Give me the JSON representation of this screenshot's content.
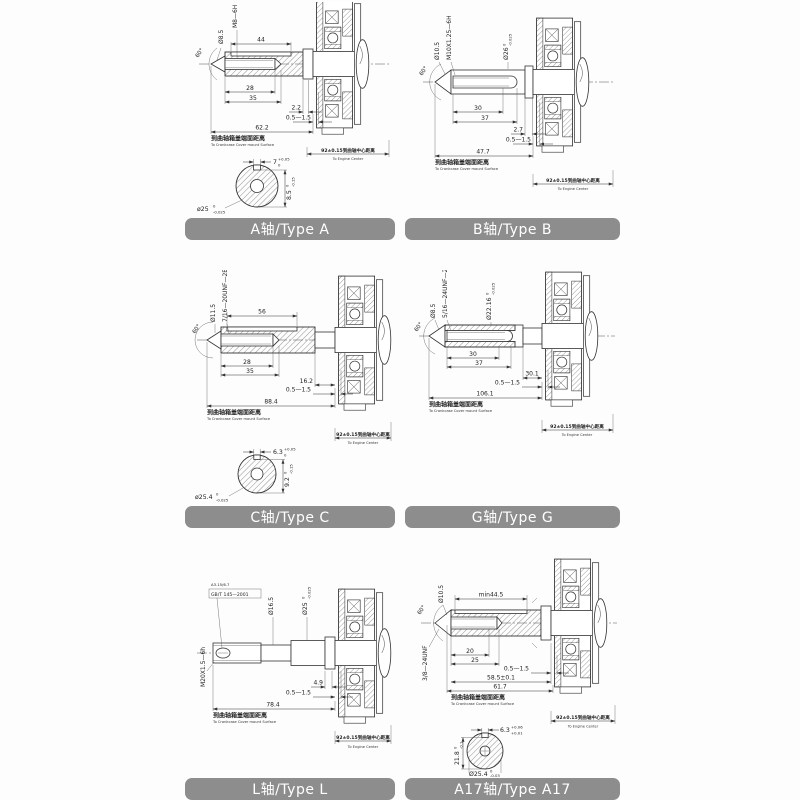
{
  "common": {
    "cover_cn": "到曲轴箱盖端面距离",
    "cover_en": "To Crankcase Cover mount Surface",
    "center_dim": "92±0.15到曲轴中心距离",
    "center_en": "To Engine Center",
    "colors": {
      "label_bar": "#8d8d8d",
      "label_text": "#ffffff",
      "line": "#333333",
      "background": "#fdfdfd"
    }
  },
  "panels": [
    {
      "id": "type-a",
      "label": "A轴/Type A",
      "thread": "M8—6H",
      "tip_dia": "Ø8.5",
      "angle": "60°",
      "dim_keyway_len": "44",
      "dim_hole_depth": "28",
      "dim_thread_depth": "35",
      "dim_step": "2.2",
      "dim_gap": "0.5—1.5",
      "dim_total": "62.2",
      "sec_key_w": {
        "v": "7",
        "sup": "+0.05",
        "sub": "0"
      },
      "sec_key_h": {
        "v": "8.5",
        "sup": "0",
        "sub": "-0.15"
      },
      "sec_dia": {
        "v": "ø25",
        "sup": "0",
        "sub": "-0.025"
      }
    },
    {
      "id": "type-b",
      "label": "B轴/Type B",
      "tip_dia": "Ø10.5",
      "thread": "M10X1.25—6H",
      "angle": "60°",
      "shaft_dia": {
        "v": "Ø26",
        "sup": "0",
        "sub": "-0.025"
      },
      "dim_hole_depth": "30",
      "dim_thread_depth": "37",
      "dim_step": "2.7",
      "dim_gap": "0.5—1.5",
      "dim_total": "47.7"
    },
    {
      "id": "type-c",
      "label": "C轴/Type C",
      "tip_dia": "Ø11.5",
      "thread": "7/16—20UNF—2B",
      "angle": "60°",
      "dim_keyway_len": "56",
      "dim_hole_depth": "28",
      "dim_thread_depth": "35",
      "dim_step": "16.2",
      "dim_gap": "0.5—1.5",
      "dim_total": "88.4",
      "sec_key_w": {
        "v": "6.3",
        "sup": "+0.05",
        "sub": "0"
      },
      "sec_key_h": {
        "v": "9.2",
        "sup": "0",
        "sub": "-0.15"
      },
      "sec_dia": {
        "v": "ø25.4",
        "sup": "0",
        "sub": "-0.025"
      }
    },
    {
      "id": "type-g",
      "label": "G轴/Type G",
      "tip_dia": "Ø8.5",
      "thread": "5/16—24UNF—2B",
      "angle": "60°",
      "shaft_dia": {
        "v": "Ø22.16",
        "sup": "0",
        "sub": "-0.025"
      },
      "dim_hole_depth": "30",
      "dim_thread_depth": "37",
      "dim_step": "30.1",
      "dim_gap": "0.5—1.5",
      "dim_total": "106.1"
    },
    {
      "id": "type-l",
      "label": "L轴/Type L",
      "center_hole": "A3.15/6.7",
      "center_std": "GB/T 145—2001",
      "thread": "M20X1.5—6h",
      "mid_dia": "Ø16.5",
      "shaft_dia": {
        "v": "Ø25",
        "sup": "0",
        "sub": "-0.025"
      },
      "dim_step": "4.9",
      "dim_gap": "0.5—1.5",
      "dim_total": "78.4"
    },
    {
      "id": "type-a17",
      "label": "A17轴/Type A17",
      "tip_dia": "Ø10.5",
      "thread": "3/8—24UNF",
      "angle": "60°",
      "dim_keyway_len": "min44.5",
      "dim_hole_depth": "20",
      "dim_thread_depth": "25",
      "dim_mid": "58.5±0.1",
      "dim_total": "61.7",
      "dim_gap": "0.5—1.5",
      "sec_key_w": {
        "v": "6.3",
        "sup": "+0.06",
        "sub": "+0.01"
      },
      "sec_key_h": {
        "v": "21.8",
        "sup": "0",
        "sub": "-0.1"
      },
      "sec_dia": {
        "v": "Ø25.4",
        "sup": "0",
        "sub": "-0.03"
      }
    }
  ]
}
